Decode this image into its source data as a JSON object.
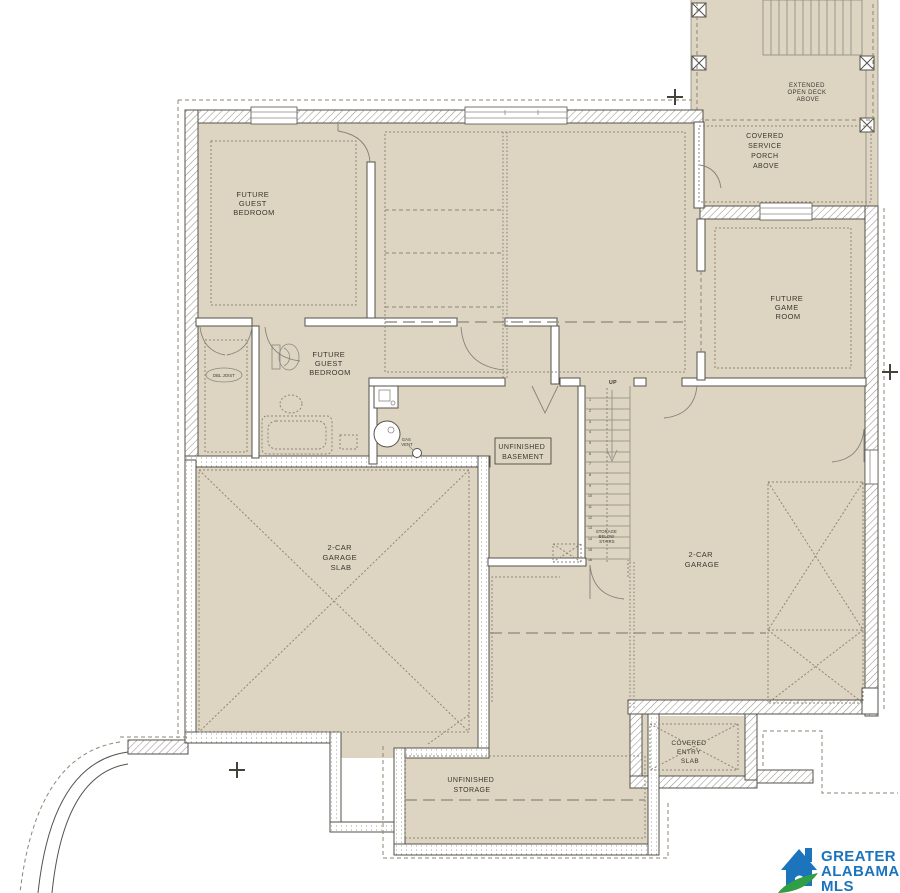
{
  "plan": {
    "rooms": {
      "guest_bedroom_1": [
        "FUTURE",
        "GUEST",
        "BEDROOM"
      ],
      "guest_bedroom_2": [
        "FUTURE",
        "GUEST",
        "BEDROOM"
      ],
      "game_room": [
        "FUTURE",
        "GAME",
        "ROOM"
      ],
      "unfinished_basement": [
        "UNFINISHED",
        "BASEMENT"
      ],
      "garage_slab": [
        "2-CAR",
        "GARAGE",
        "SLAB"
      ],
      "garage": [
        "2-CAR",
        "GARAGE"
      ],
      "unfinished_storage": [
        "UNFINISHED",
        "STORAGE"
      ],
      "covered_entry_slab": [
        "COVERED",
        "ENTRY",
        "SLAB"
      ],
      "extended_open_deck": [
        "EXTENDED",
        "OPEN DECK",
        "ABOVE"
      ],
      "covered_service_porch": [
        "COVERED",
        "SERVICE",
        "PORCH",
        "ABOVE"
      ]
    },
    "annotations": {
      "up": "UP",
      "dbl_joist": "DBL JOIST",
      "gas_vent": [
        "GAS",
        "VENT"
      ],
      "storage_below_stairs": [
        "STORAGE",
        "BELOW",
        "STAIRS"
      ],
      "stair_numbers": [
        "1",
        "2",
        "3",
        "4",
        "5",
        "6",
        "7",
        "8",
        "9",
        "10",
        "11",
        "12",
        "13",
        "14",
        "15",
        "16"
      ]
    },
    "colors": {
      "floor_fill": "#ddd5c1",
      "wall_line": "#55524b",
      "dashed_line": "#8d8676",
      "text_color": "#3a372f"
    }
  },
  "logo": {
    "lines": [
      "GREATER",
      "ALABAMA",
      "MLS"
    ],
    "blue": "#1b74bc",
    "green": "#2f9e45"
  }
}
